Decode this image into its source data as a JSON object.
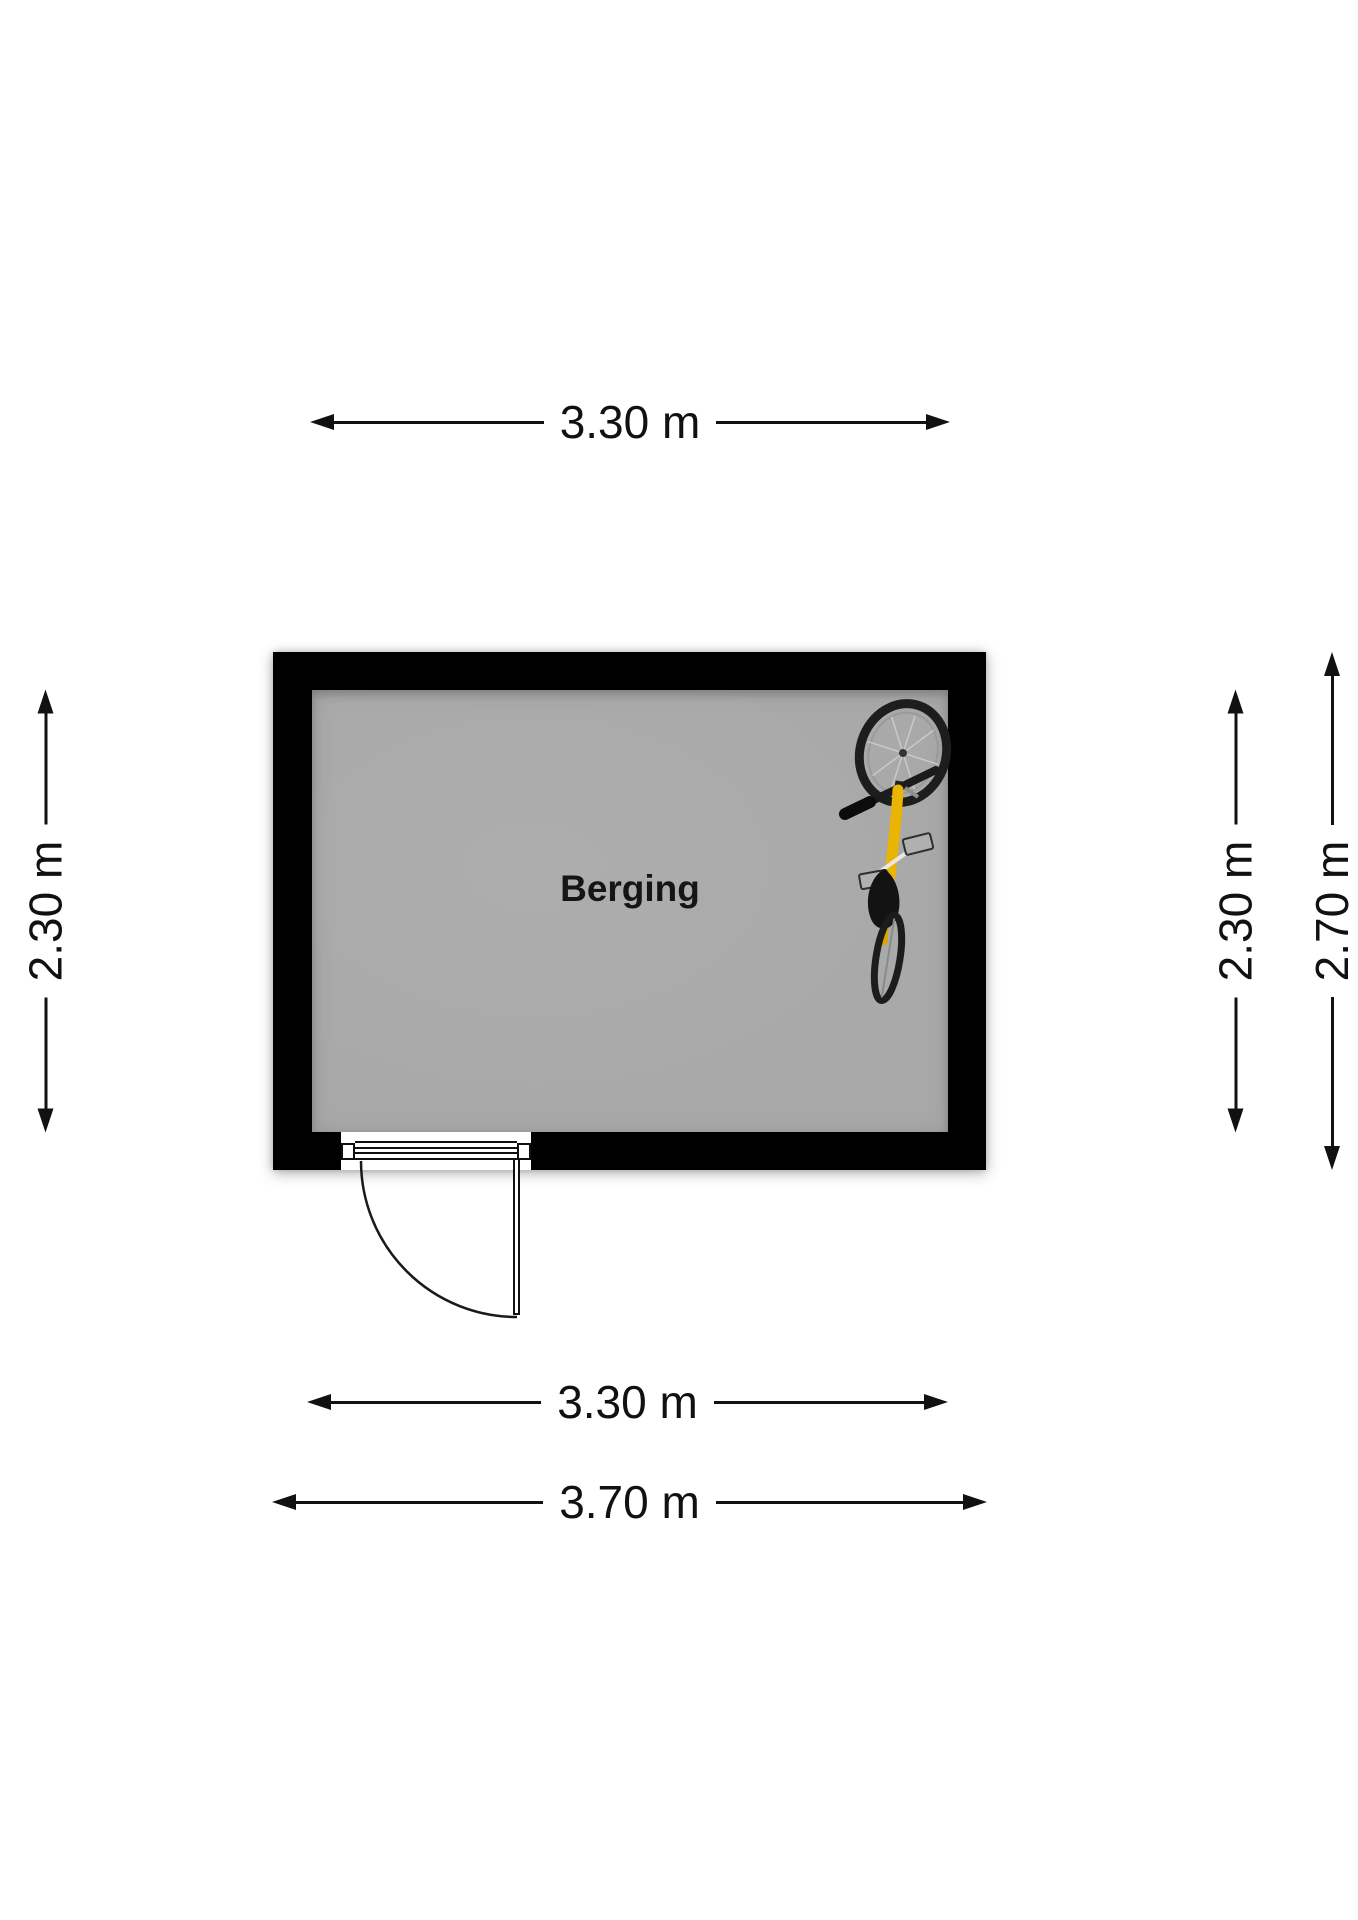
{
  "room": {
    "label": "Berging"
  },
  "dimensions": {
    "top_width": "3.30 m",
    "bottom_inner_width": "3.30 m",
    "bottom_outer_width": "3.70 m",
    "left_inner_height": "2.30 m",
    "right_inner_height": "2.30 m",
    "right_outer_height": "2.70 m"
  },
  "objects": [
    {
      "name": "bicycle",
      "frame_color": "#eab502"
    }
  ],
  "colors": {
    "wall": "#000000",
    "floor": "#a9a9a9",
    "background": "#ffffff",
    "line": "#111111"
  }
}
